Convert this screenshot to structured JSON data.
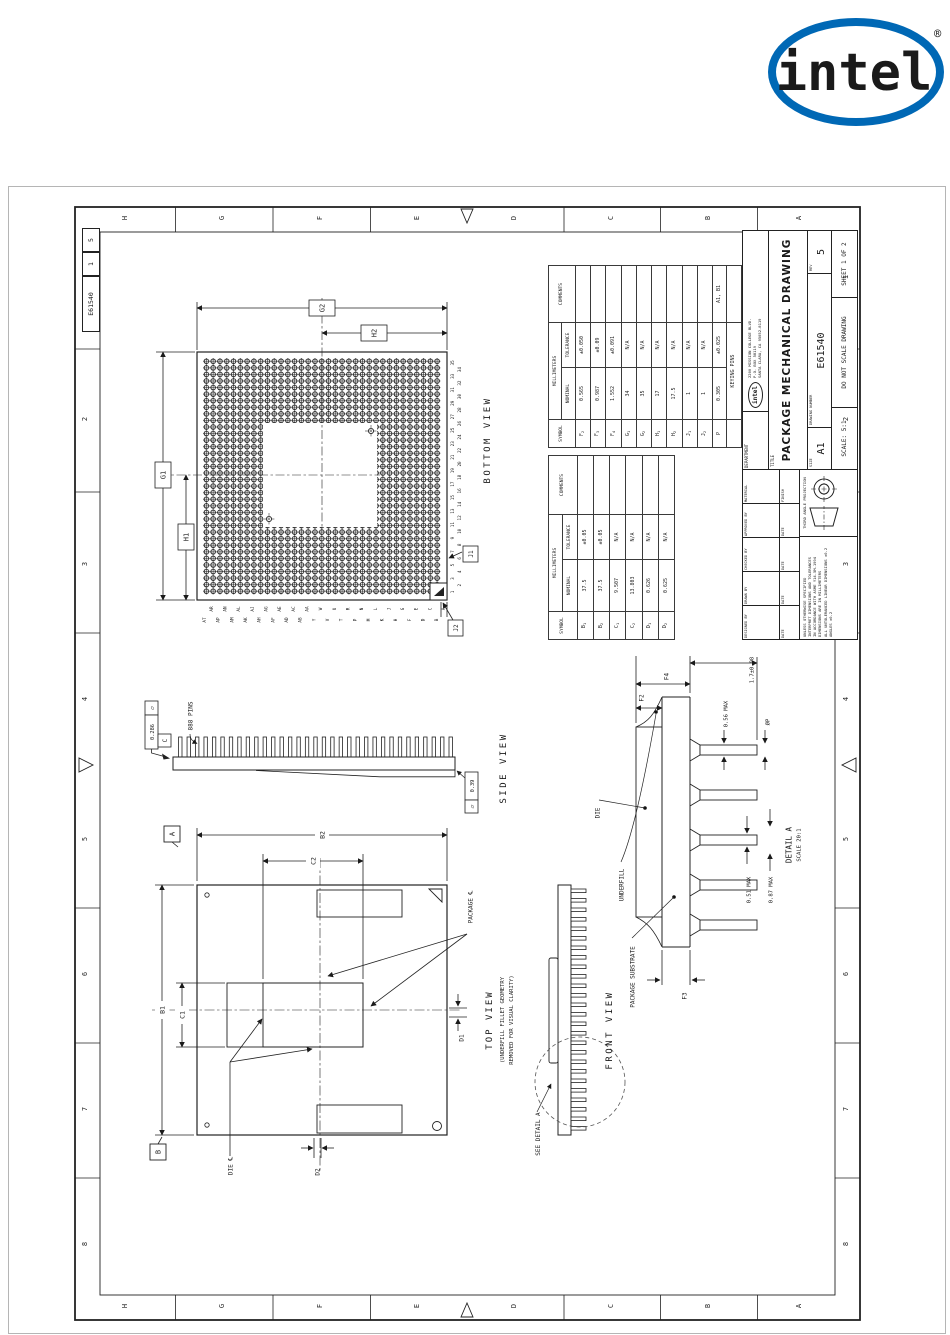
{
  "logo": {
    "text": "intel",
    "registered": "®"
  },
  "margin": {
    "letters": [
      "H",
      "G",
      "F",
      "E",
      "D",
      "C",
      "B",
      "A"
    ],
    "numbers": [
      "1",
      "2",
      "3",
      "4",
      "5",
      "6",
      "7",
      "8"
    ],
    "strip": {
      "dwg_no": "E61540",
      "sheet": "1",
      "rev": "5"
    }
  },
  "bottom_view": {
    "title": "BOTTOM VIEW",
    "dims": {
      "g2": "G2",
      "h2": "H2",
      "g1": "G1",
      "h1": "H1",
      "j1": "J1",
      "j2": "J2"
    },
    "col_numbers": [
      "1",
      "2",
      "3",
      "4",
      "5",
      "6",
      "7",
      "8",
      "9",
      "10",
      "11",
      "12",
      "13",
      "14",
      "15",
      "16",
      "17",
      "18",
      "19",
      "20",
      "21",
      "22",
      "23",
      "24",
      "25",
      "26",
      "27",
      "28",
      "29",
      "30",
      "31",
      "32",
      "33",
      "34",
      "35"
    ],
    "row_letters": [
      "AT",
      "AR",
      "AP",
      "AN",
      "AM",
      "AL",
      "AK",
      "AJ",
      "AH",
      "AG",
      "AF",
      "AE",
      "AD",
      "AC",
      "AB",
      "AA",
      "Y",
      "W",
      "V",
      "U",
      "T",
      "R",
      "P",
      "N",
      "M",
      "L",
      "K",
      "J",
      "H",
      "G",
      "F",
      "E",
      "D",
      "C",
      "B",
      "A"
    ]
  },
  "side_view": {
    "title": "SIDE VIEW",
    "pins_label": "888 PINS",
    "fcf1": {
      "symbol": "▱",
      "value": "0.286",
      "datum": "C"
    },
    "fcf2": {
      "symbol": "▱",
      "value": "0.39"
    }
  },
  "top_view": {
    "title": "TOP VIEW",
    "subtitle1": "(UNDERFILL FILLET GEOMETRY",
    "subtitle2": "REMOVED FOR VISUAL CLARITY)",
    "package_cl": "PACKAGE ℄",
    "die_cl": "DIE ℄",
    "datum_a": "A",
    "datum_b": "B",
    "dims": {
      "b1": "B1",
      "b2": "B2",
      "c1": "C1",
      "c2": "C2",
      "d1": "D1",
      "d2": "D2"
    }
  },
  "front_view": {
    "title": "FRONT VIEW",
    "see_detail": "SEE DETAIL A"
  },
  "detail_a": {
    "title": "DETAIL A",
    "scale": "SCALE 20:1",
    "die": "DIE",
    "underfill": "UNDERFILL",
    "substrate": "PACKAGE SUBSTRATE",
    "dims": {
      "pin_len": "1.7±0.08",
      "max056": "0.56 MAX",
      "dia": "ØP",
      "f2": "F2",
      "f3": "F3",
      "f4": "F4",
      "max051": "0.51 MAX",
      "max087": "0.87 MAX"
    }
  },
  "tables": {
    "headers": {
      "symbol": "SYMBOL",
      "mm": "MILLIMETERS",
      "nominal": "NOMINAL",
      "tolerance": "TOLERANCE",
      "comments": "COMMENTS"
    },
    "table1": {
      "rows": [
        {
          "symbol": "F2",
          "nominal": "0.565",
          "tolerance": "±0.050",
          "comments": ""
        },
        {
          "symbol": "F3",
          "nominal": "0.987",
          "tolerance": "±0.09",
          "comments": ""
        },
        {
          "symbol": "F4",
          "nominal": "1.552",
          "tolerance": "±0.091",
          "comments": ""
        },
        {
          "symbol": "G1",
          "nominal": "34",
          "tolerance": "N/A",
          "comments": ""
        },
        {
          "symbol": "G2",
          "nominal": "35",
          "tolerance": "N/A",
          "comments": ""
        },
        {
          "symbol": "H1",
          "nominal": "17",
          "tolerance": "N/A",
          "comments": ""
        },
        {
          "symbol": "H2",
          "nominal": "17.5",
          "tolerance": "N/A",
          "comments": ""
        },
        {
          "symbol": "J1",
          "nominal": "1",
          "tolerance": "N/A",
          "comments": ""
        },
        {
          "symbol": "J2",
          "nominal": "1",
          "tolerance": "N/A",
          "comments": ""
        },
        {
          "symbol": "P",
          "nominal": "0.305",
          "tolerance": "±0.025",
          "comments": "A1, B1"
        },
        {
          "symbol": "",
          "span": "KEYING PINS",
          "comments": ""
        }
      ]
    },
    "table2": {
      "rows": [
        {
          "symbol": "B1",
          "nominal": "37.5",
          "tolerance": "±0.05",
          "comments": ""
        },
        {
          "symbol": "B2",
          "nominal": "37.5",
          "tolerance": "±0.05",
          "comments": ""
        },
        {
          "symbol": "C1",
          "nominal": "9.507",
          "tolerance": "N/A",
          "comments": ""
        },
        {
          "symbol": "C2",
          "nominal": "13.803",
          "tolerance": "N/A",
          "comments": ""
        },
        {
          "symbol": "D1",
          "nominal": "0.626",
          "tolerance": "N/A",
          "comments": ""
        },
        {
          "symbol": "D2",
          "nominal": "0.625",
          "tolerance": "N/A",
          "comments": ""
        }
      ]
    }
  },
  "title_block": {
    "department": "DEPARTMENT",
    "logo": "intel",
    "address1": "2200 MISSION COLLEGE BLVD.",
    "address2": "P.O. BOX 58119",
    "address3": "SANTA CLARA, CA 95052-8119",
    "title_label": "TITLE",
    "title": "PACKAGE MECHANICAL DRAWING",
    "size_label": "SIZE",
    "size": "A1",
    "dwg_label": "DRAWING NUMBER",
    "dwg_no": "E61540",
    "rev_label": "REV",
    "rev": "5",
    "scale": "SCALE: 5:1",
    "do_not_scale": "DO NOT SCALE DRAWING",
    "sheet": "SHEET 1 OF 2",
    "designed": "DESIGNED BY",
    "drawn": "DRAWN BY",
    "checked": "CHECKED BY",
    "approved": "APPROVED BY",
    "material": "MATERIAL",
    "finish": "FINISH",
    "date": "DATE",
    "projection": "THIRD ANGLE PROJECTION",
    "notes": "UNLESS OTHERWISE SPECIFIED\nINTERPRET DIMENSIONS AND TOLERANCES\nIN ACCORDANCE WITH ASME Y14.5M-1994\nDIMENSIONS ARE IN MILLIMETERS\nALL UNTOLERANCED LINEAR DIMENSIONS ±0.2\nANGLES ±0.2"
  },
  "colors": {
    "line": "#1a1a1a",
    "intel_blue": "#0068b5"
  }
}
